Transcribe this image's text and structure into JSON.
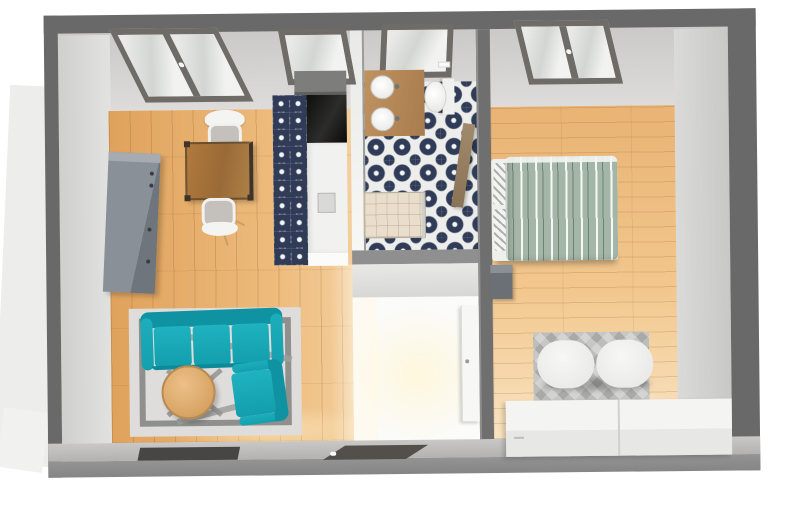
{
  "scene": {
    "type": "3d-floor-plan",
    "description": "Top-down 3D rendering of a one-bedroom apartment with living-dining room, kitchen strip, bathroom and bedroom"
  },
  "colors": {
    "outer_wall": "#696969",
    "inner_wall_face": "#d8d6d4",
    "living_floor_wood": "#e6b06e",
    "bedroom_floor_wood": "#eec088",
    "tile_navy": "#2f3b57",
    "tile_white": "#edeeec",
    "sofa_teal": "#17a7b5",
    "duvet_sage": "#a4b6a7",
    "rug_gray": "#dedddb",
    "counter_white": "#f0f0ee",
    "vanity_wood": "#b5885a",
    "appliance_black": "#141414",
    "hall_light": "#fbfbf9"
  },
  "rooms": {
    "living": {
      "label": "Living / dining room"
    },
    "kitchen": {
      "label": "Kitchen strip"
    },
    "bathroom": {
      "label": "Bathroom"
    },
    "bedroom": {
      "label": "Bedroom"
    },
    "hallway": {
      "label": "Hallway"
    }
  },
  "furniture": {
    "sofa": "Teal three-seat sofa",
    "armchair": "Teal armchair",
    "coffee_table": "Round wooden coffee table",
    "living_rug": "Light gray rug with dark border",
    "lamp_frame": "Gray floor-lamp frame",
    "dining_table": "Square wooden dining table with metal frame",
    "chair_north": "White dining chair",
    "chair_south": "White dining chair",
    "storage_cabinet": "Tall gray storage cabinet",
    "tv": "Wall-mounted TV panel",
    "entry_door": "Entrance door with white handle",
    "wall_cabinet": "Gray kitchen wall cabinet",
    "oven": "Built-in black appliance",
    "counter": "White kitchen counter run",
    "kitchen_sink": "Kitchen sink",
    "kitchen_floor": "Patterned cement-tile kitchen floor",
    "bathroom_floor": "Patterned cement-tile bathroom floor",
    "vanity": "Wooden vanity top",
    "basin_north": "Round white basin",
    "basin_south": "Round white basin",
    "toilet": "White toilet",
    "flush_plate": "Wall flush plate",
    "shower": "Walk-in shower tray",
    "bathroom_door": "Open wooden bathroom door",
    "bathroom_window": "Bathroom window",
    "living_window_large": "Large double window",
    "living_window_small": "Single window",
    "bedroom_window": "Bedroom double window",
    "bed": "Double bed with sage patterned duvet",
    "pillow_1": "Patterned pillow",
    "pillow_2": "Patterned pillow",
    "nightstand": "Dark gray nightstand",
    "bedroom_rug": "Gray patterned rug",
    "bench": "White upholstered bench",
    "dresser": "Long white low dresser",
    "bedroom_door": "Open white door leaf"
  }
}
